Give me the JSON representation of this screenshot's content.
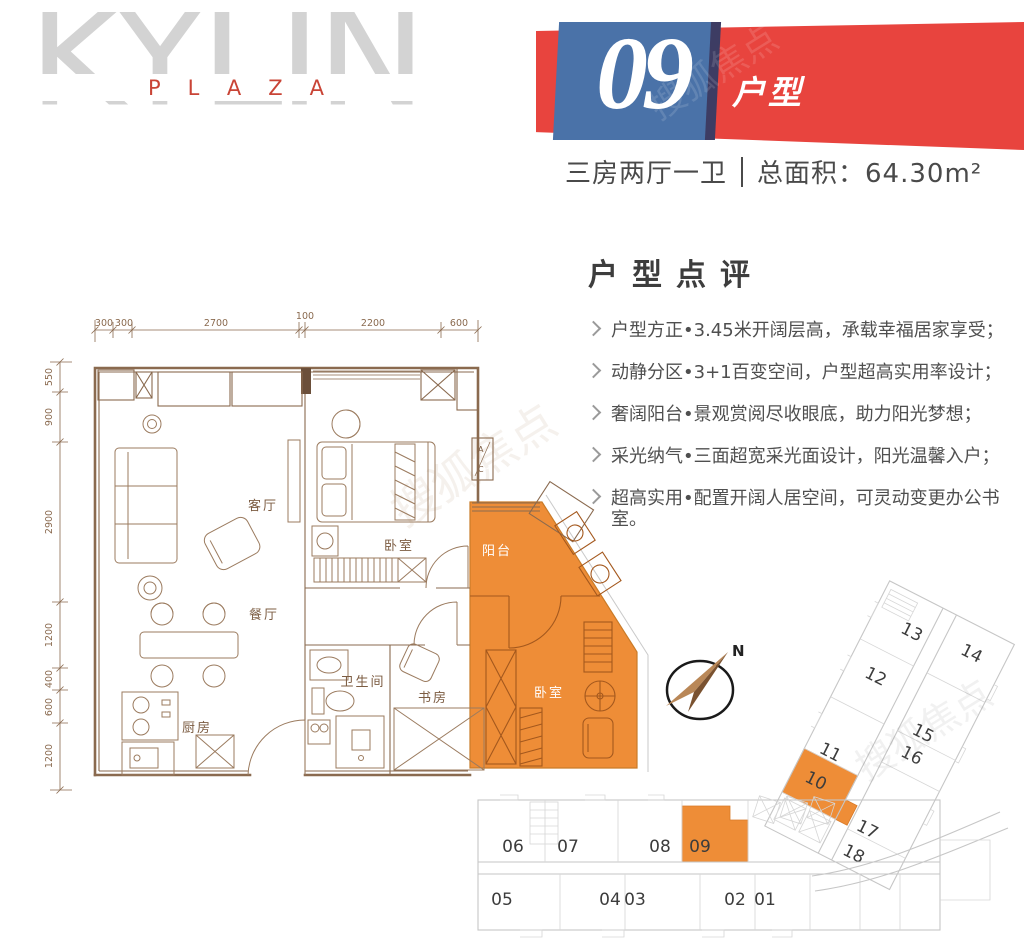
{
  "logo": {
    "title": "KYLIN",
    "subtitle": "PLAZA"
  },
  "banner": {
    "number": "09",
    "label": "户型"
  },
  "summary": {
    "rooms": "三房两厅一卫",
    "area": "总面积：64.30m²"
  },
  "review": {
    "title": "户型点评",
    "bullets": [
      "户型方正•3.45米开阔层高，承载幸福居家享受；",
      "动静分区•3+1百变空间，户型超高实用率设计；",
      "奢阔阳台•景观赏阅尽收眼底，助力阳光梦想；",
      "采光纳气•三面超宽采光面设计，阳光温馨入户；",
      "超高实用•配置开阔人居空间，可灵动变更办公书室。"
    ]
  },
  "floorplan": {
    "dims_top": [
      "300",
      "300",
      "2700",
      "100",
      "2200",
      "600"
    ],
    "dims_left": [
      "550",
      "900",
      "2900",
      "1200",
      "400",
      "600",
      "1200"
    ],
    "rooms": {
      "living": "客厅",
      "master_bedroom": "卧室",
      "dining": "餐厅",
      "kitchen": "厨房",
      "bathroom": "卫生间",
      "study": "书房",
      "balcony": "阳台",
      "second_bedroom": "卧室"
    },
    "ac": {
      "top": "A",
      "bottom": "C"
    }
  },
  "compass": {
    "north": "N"
  },
  "site_plan": {
    "bottom_top_row": [
      "06",
      "07",
      "08",
      "09"
    ],
    "bottom_bottom_row": [
      "05",
      "04",
      "03",
      "02",
      "01"
    ],
    "wing_left_col": [
      "13",
      "12",
      "11",
      "10"
    ],
    "wing_right_col": [
      "14",
      "15",
      "16",
      "17",
      "18"
    ],
    "highlighted": [
      "09",
      "10"
    ]
  },
  "watermark": {
    "text": "搜狐焦点"
  },
  "colors": {
    "accent_red": "#e8443e",
    "accent_blue": "#4a72a8",
    "highlight_orange": "#ee8d37",
    "plan_line": "#8a6a4f",
    "site_line": "#c6c6c6"
  }
}
